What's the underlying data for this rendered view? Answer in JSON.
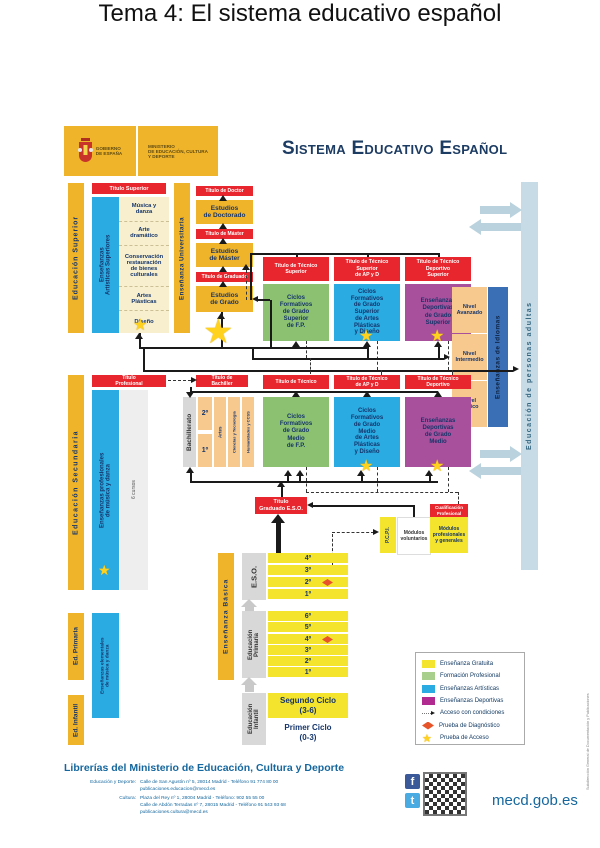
{
  "page": {
    "title": "Tema 4: El sistema educativo español"
  },
  "brand": {
    "gobierno": "GOBIERNO\nDE ESPAÑA",
    "ministerio": "MINISTERIO\nDE EDUCACIÓN, CULTURA\nY DEPORTE",
    "header": "Sistema Educativo Español"
  },
  "sup": {
    "bar": "Educación Superior",
    "titulo": "Título Superior",
    "artisticas": "Enseñanzas\nArtísticas Superiores",
    "items": [
      "Música y\ndanza",
      "Arte\ndramático",
      "Conservación\nrestauración\nde bienes\nculturales",
      "Artes\nPlásticas",
      "Diseño"
    ],
    "universitaria": "Enseñanza Universitaria",
    "uni": {
      "t_doctor": "Título de Doctor",
      "e_doctorado": "Estudios\nde Doctorado",
      "t_master": "Título de Máster",
      "e_master": "Estudios\nde Máster",
      "t_graduado": "Título de Graduado",
      "e_grado": "Estudios\nde Grado"
    }
  },
  "gs": {
    "labels": [
      "Título de Técnico\nSuperior",
      "Título de Técnico\nSuperior\nde AP y D",
      "Título de Técnico\nDeportivo\nSuperior"
    ],
    "boxes": [
      "Ciclos\nFormativos\nde Grado\nSuperior\nde F.P.",
      "Ciclos\nFormativos\nde Grado\nSuperior\nde Artes\nPlásticas\ny Diseño",
      "Enseñanzas\nDeportivas\nde Grado\nSuperior"
    ]
  },
  "idiomas": {
    "levels": [
      "Nivel\nAvanzado",
      "Nivel\nIntermedio",
      "Nivel\nBásico"
    ],
    "bar": "Enseñanzas de Idiomas"
  },
  "adultas": {
    "bar": "Educación de personas adultas"
  },
  "sec": {
    "bar": "Educación Secundaria",
    "titulo_profesional": "Título\nProfesional",
    "musica": "Enseñanzas profesionales\nde música y danza",
    "cursos": "6 cursos",
    "titulo_bachiller": "Título de\nBachiller",
    "bachillerato": "Bachillerato",
    "years": [
      "2º",
      "1º"
    ],
    "modalidades": [
      "Artes",
      "Ciencias y Tecnología",
      "Humanidades y CCSS"
    ]
  },
  "gm": {
    "labels": [
      "Título de Técnico",
      "Título de Técnico\nde AP y D",
      "Título de Técnico\nDeportivo"
    ],
    "boxes": [
      "Ciclos\nFormativos\nde Grado\nMedio\nde F.P.",
      "Ciclos\nFormativos\nde Grado\nMedio\nde Artes\nPlásticas\ny Diseño",
      "Enseñanzas\nDeportivas\nde Grado\nMedio"
    ]
  },
  "salida": {
    "titulo_graduado": "Título\nGraduado E.S.O.",
    "pcpi": "P.C.P.I.",
    "mod_vol": "Módulos\nvoluntarios",
    "cualificacion": "Cualificación\nProfesional",
    "mod_prof": "Módulos\nprofesionales\ny generales"
  },
  "basica": {
    "bar": "Enseñanza Básica",
    "eso": "E.S.O.",
    "eso_rows": [
      "4º",
      "3º",
      "2º",
      "1º"
    ],
    "primaria": "Educación\nPrimaria",
    "primaria_rows": [
      "6º",
      "5º",
      "4º",
      "3º",
      "2º",
      "1º"
    ],
    "infantil": "Educación\nInfantil",
    "ciclo2": "Segundo Ciclo\n(3-6)",
    "ciclo1": "Primer Ciclo\n(0-3)"
  },
  "lb": {
    "ed_primaria": "Ed. Primaria",
    "elementales": "Enseñanzas elementales\nde música y danza",
    "ed_infantil": "Ed. Infantil"
  },
  "legend": {
    "items": [
      {
        "label": "Enseñanza Gratuita",
        "color": "#f4e42e"
      },
      {
        "label": "Formación Profesional",
        "color": "#a9cf8c"
      },
      {
        "label": "Enseñanzas Artísticas",
        "color": "#2aabe2"
      },
      {
        "label": "Enseñanzas Deportivas",
        "color": "#b02a8f"
      },
      {
        "label": "Acceso con condiciones",
        "symbol": "dotted-arrow"
      },
      {
        "label": "Prueba de Diagnóstico",
        "symbol": "red-diamond"
      },
      {
        "label": "Prueba de Acceso",
        "symbol": "yellow-star"
      }
    ]
  },
  "footer": {
    "librerias": "Librerías del Ministerio de Educación, Cultura y Deporte",
    "edu_label": "Educación y Deporte:",
    "edu_line1": "Calle de San Agustín nº 5, 28014 Madrid - Teléfono 91 774 80 00",
    "edu_line2": "publicaciones.educacion@mecd.es",
    "cultura_label": "Cultura:",
    "cultura_line1": "Plaza del Rey nº 1, 28004 Madrid - Teléfono: 902 55 55 00",
    "cultura_line2": "Calle de Abdón Terradas nº 7, 28015 Madrid - Teléfono 91 543 93 68",
    "cultura_line3": "publicaciones.cultura@mecd.es",
    "website": "mecd.gob.es",
    "fb": "f",
    "tw": "t",
    "side_note": "Subdirección General de Documentación y Publicaciones"
  },
  "colors": {
    "gold": "#f0b42a",
    "bright_yellow": "#f4e42e",
    "red_label": "#e8262d",
    "cyan": "#2aabe2",
    "green": "#8cc172",
    "purple": "#a9509c",
    "tan": "#f7c98f",
    "cream": "#f7efcd",
    "idiomas_blue": "#3a6fb5",
    "adultas_blue": "#c6dbe6",
    "navy_text": "#15356b",
    "footer_blue": "#15679e"
  }
}
